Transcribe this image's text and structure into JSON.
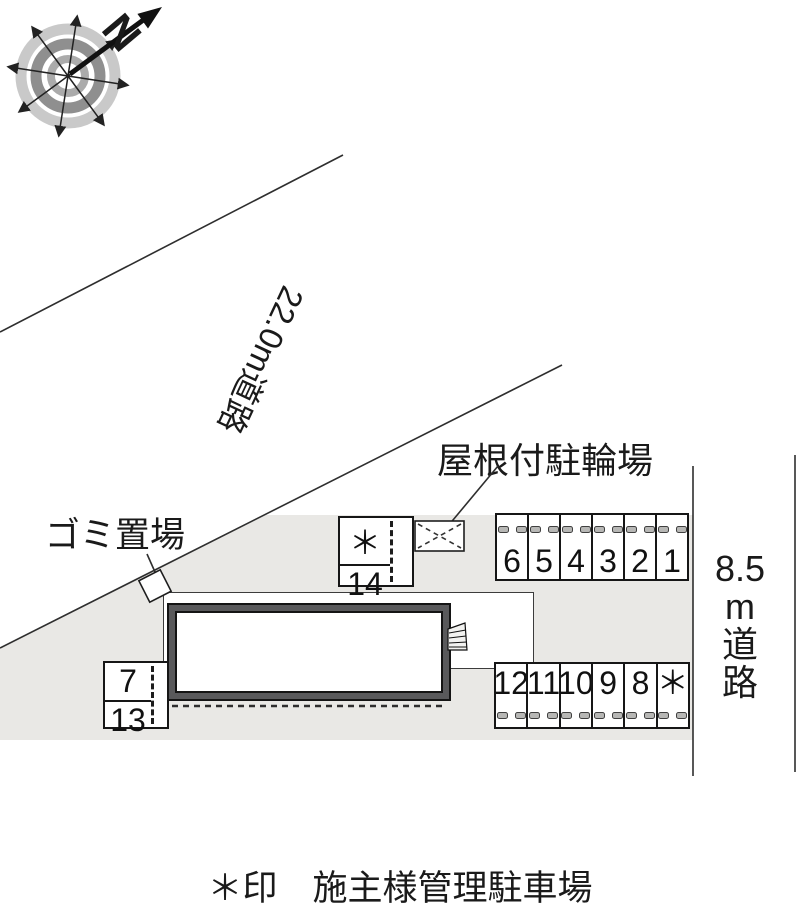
{
  "compass": {
    "north_label": "N"
  },
  "roads": {
    "northwest_road": "22.0m道路",
    "east_road_lines": [
      "8.5",
      "m",
      "道",
      "路"
    ]
  },
  "labels": {
    "bicycle_parking": "屋根付駐輪場",
    "trash_area": "ゴミ置場"
  },
  "parking": {
    "row_north": [
      "6",
      "5",
      "4",
      "3",
      "2",
      "1"
    ],
    "row_south": [
      "12",
      "11",
      "10",
      "9",
      "8",
      "＊"
    ],
    "stack_center": [
      "＊",
      "14"
    ],
    "stack_west": [
      "7",
      "13"
    ]
  },
  "caption": "＊印　施主様管理駐車場",
  "colors": {
    "plot_gray": "#e9e8e5",
    "building_frame": "#59595b",
    "line": "#2e2e2e"
  }
}
